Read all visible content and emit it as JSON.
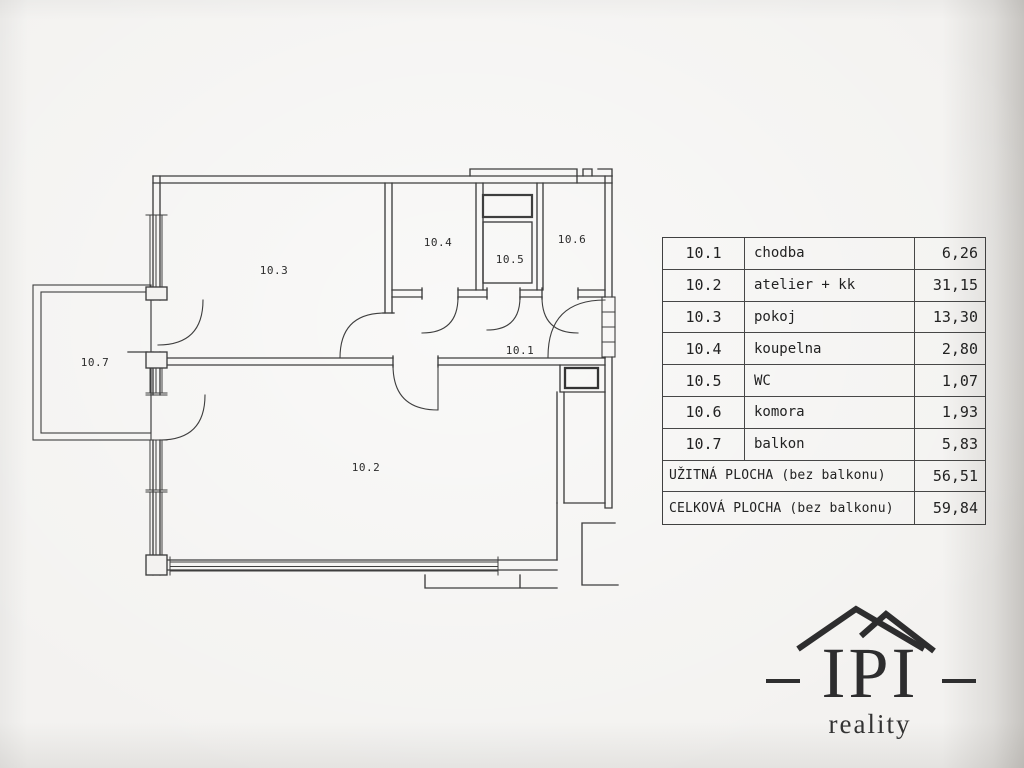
{
  "colors": {
    "line": "#3e3e3e",
    "paper": "#f3f2f0",
    "logo": "#2d2d2e"
  },
  "plan": {
    "labels": {
      "r101": "10.1",
      "r102": "10.2",
      "r103": "10.3",
      "r104": "10.4",
      "r105": "10.5",
      "r106": "10.6",
      "r107": "10.7"
    }
  },
  "table": {
    "rows": [
      {
        "num": "10.1",
        "name": "chodba",
        "area": "6,26"
      },
      {
        "num": "10.2",
        "name": "atelier + kk",
        "area": "31,15"
      },
      {
        "num": "10.3",
        "name": "pokoj",
        "area": "13,30"
      },
      {
        "num": "10.4",
        "name": "koupelna",
        "area": "2,80"
      },
      {
        "num": "10.5",
        "name": "WC",
        "area": "1,07"
      },
      {
        "num": "10.6",
        "name": "komora",
        "area": "1,93"
      },
      {
        "num": "10.7",
        "name": "balkon",
        "area": "5,83"
      }
    ],
    "summary": [
      {
        "label": "UŽITNÁ PLOCHA (bez balkonu)",
        "area": "56,51"
      },
      {
        "label": "CELKOVÁ PLOCHA (bez balkonu)",
        "area": "59,84"
      }
    ]
  },
  "logo": {
    "title": "IPI",
    "subtitle": "reality"
  }
}
